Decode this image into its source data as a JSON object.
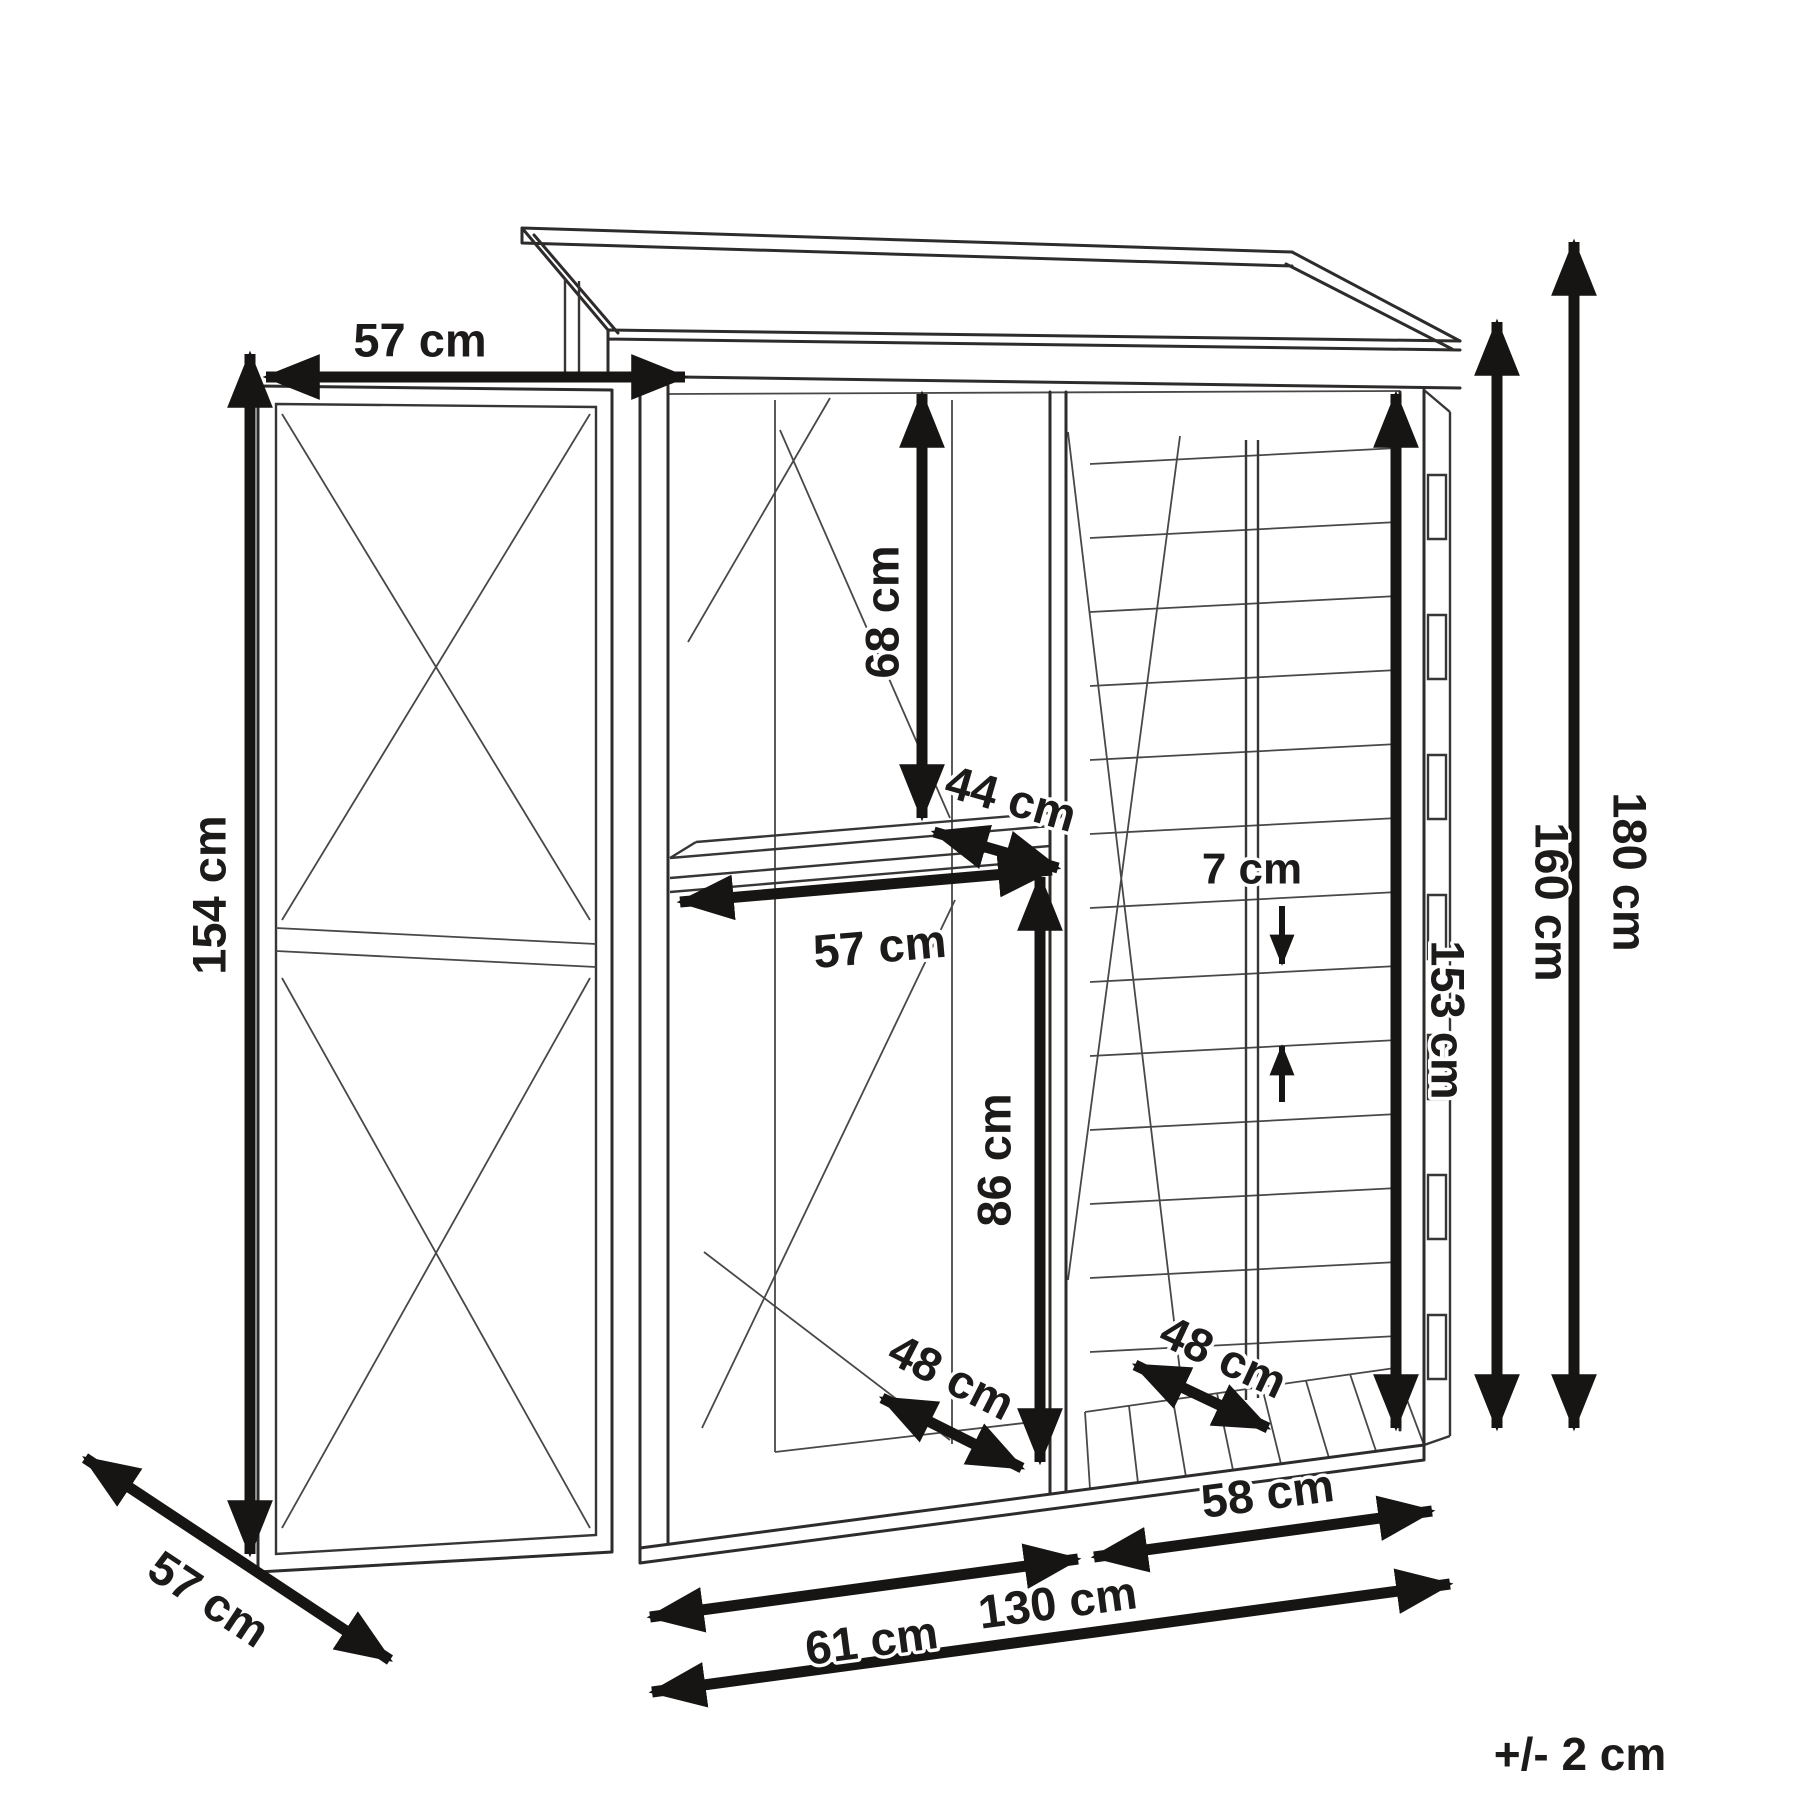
{
  "diagram": {
    "title_semantic": "garden-shed-dimension-diagram",
    "tolerance_note": "+/- 2 cm",
    "dimensions": {
      "door_width": {
        "label": "57 cm",
        "meaning": "width of open door (top)"
      },
      "door_height": {
        "label": "154 cm",
        "meaning": "door height (left side)"
      },
      "door_depth": {
        "label": "57 cm",
        "meaning": "door swing depth (bottom left diagonal)"
      },
      "shelf_clearance": {
        "label": "68 cm",
        "meaning": "height above shelf"
      },
      "shelf_depth": {
        "label": "44 cm",
        "meaning": "shelf depth"
      },
      "shelf_width": {
        "label": "57 cm",
        "meaning": "shelf width"
      },
      "under_shelf": {
        "label": "86 cm",
        "meaning": "height below shelf"
      },
      "tool_floor_depth": {
        "label": "48 cm",
        "meaning": "tool section floor depth"
      },
      "log_floor_depth": {
        "label": "48 cm",
        "meaning": "log store floor depth"
      },
      "slat_gap": {
        "label": "7 cm",
        "meaning": "gap between wall slats"
      },
      "interior_height": {
        "label": "153 cm",
        "meaning": "interior height at right wall"
      },
      "eaves_height": {
        "label": "160 cm",
        "meaning": "height to eaves"
      },
      "total_height": {
        "label": "180 cm",
        "meaning": "total height to roof peak"
      },
      "tool_section_width": {
        "label": "61 cm",
        "meaning": "tool section width"
      },
      "log_section_width": {
        "label": "58 cm",
        "meaning": "log store width"
      },
      "total_width": {
        "label": "130 cm",
        "meaning": "total width"
      }
    }
  }
}
